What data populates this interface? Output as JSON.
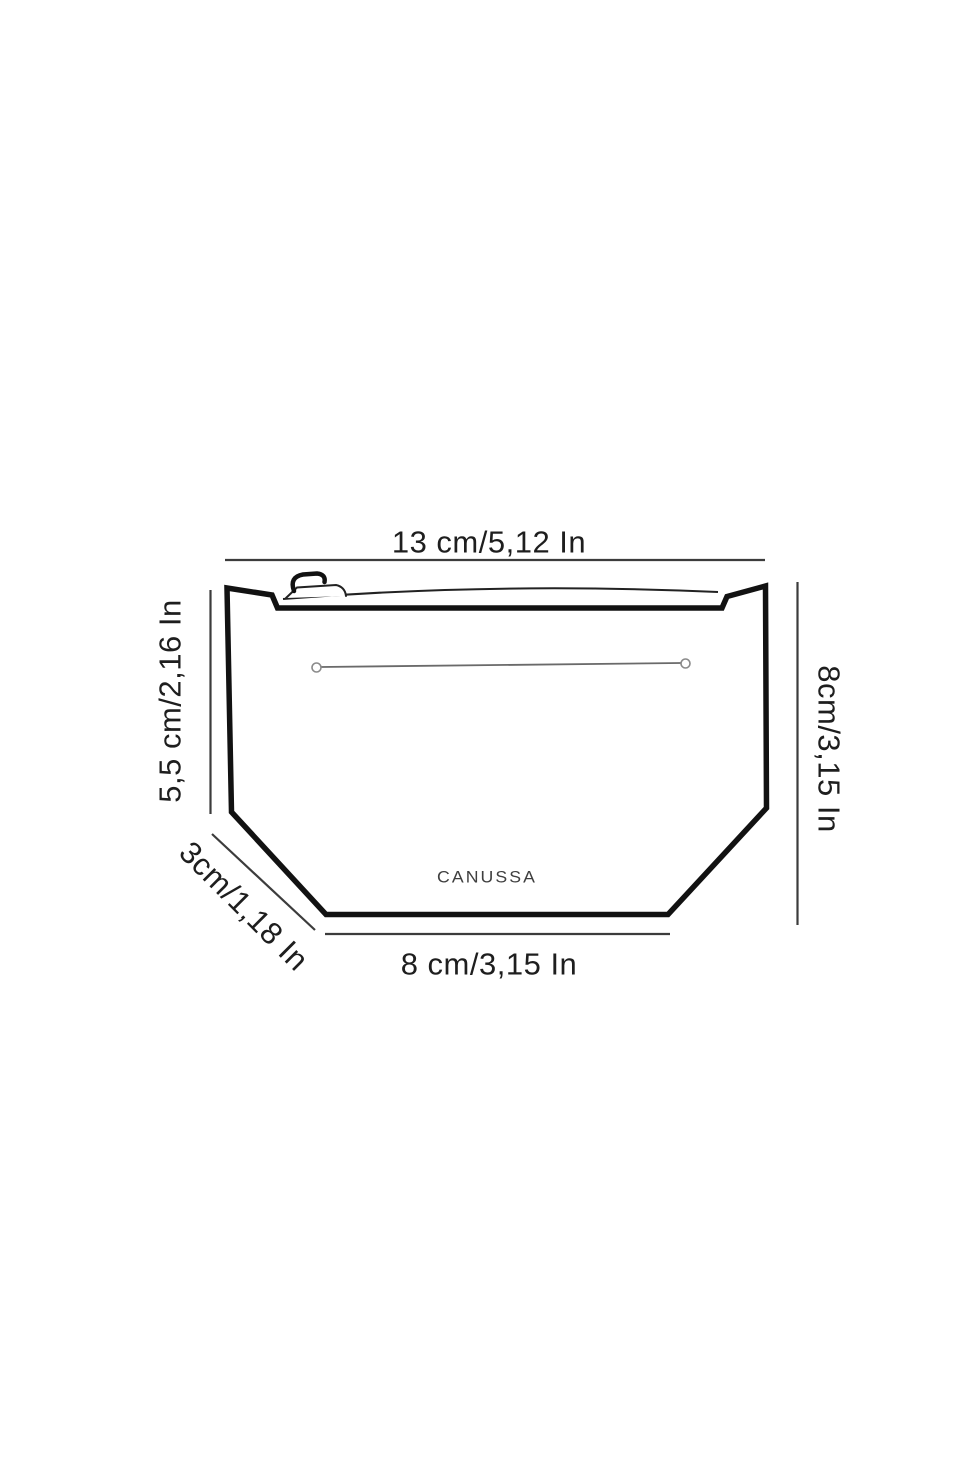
{
  "figure": {
    "brand": "CANUSSA",
    "labels": {
      "top_width": "13 cm/5,12 In",
      "left_height": "5,5 cm/2,16 In",
      "bottom_depth": "3cm/1,18 In",
      "bottom_width": "8 cm/3,15 In",
      "right_height": "8cm/3,15 In"
    },
    "colors": {
      "background": "#ffffff",
      "outline": "#121212",
      "dimension_line": "#3c3c3c",
      "label_text": "#1e1e1e",
      "pocket_line": "#6a6a6a",
      "brand_text": "#3f3f3f"
    }
  }
}
